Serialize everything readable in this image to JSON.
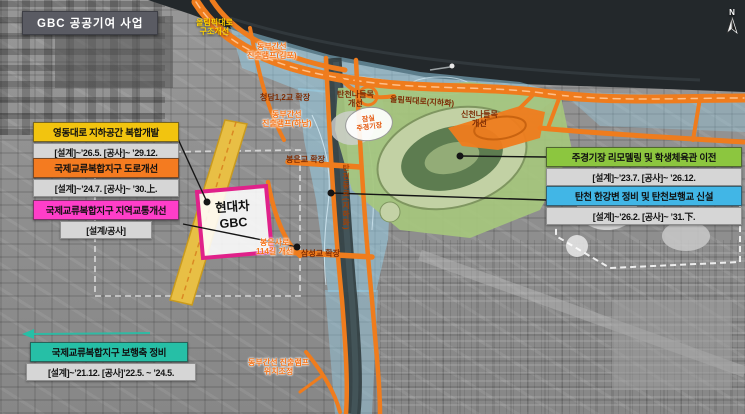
{
  "header": {
    "title": "GBC 공공기여 사업"
  },
  "compass": {
    "label": "N"
  },
  "colors": {
    "yellow": "#f2c40f",
    "orange": "#f47b20",
    "magenta": "#ff3ec9",
    "green": "#8cc63f",
    "blue": "#41b6e6",
    "teal": "#26bfa6",
    "schedule_bg": "#d6d6d6",
    "road_orange": "#ef7c1d",
    "han_river": "#23282b",
    "overlay_blue": "#96d2eb",
    "stadium_green": "#a6c77d",
    "yeongdong_band_yellow": "#e8bf45",
    "site_border_magenta": "#e0218a"
  },
  "callouts": [
    {
      "title": "영동대로 지하공간 복합개발",
      "schedule": "[설계]~’26.5. [공사]~ ’29.12.",
      "color": "#f2c40f"
    },
    {
      "title": "국제교류복합지구 도로개선",
      "schedule": "[설계]~’24.7. [공사]~ ’30.上.",
      "color": "#f47b20"
    },
    {
      "title": "국제교류복합지구 지역교통개선",
      "schedule": "[설계/공사]",
      "color": "#ff3ec9"
    },
    {
      "title": "주경기장 리모델링 및 학생체육관 이전",
      "schedule": "[설계]~’23.7. [공사]~ ’26.12.",
      "color": "#8cc63f"
    },
    {
      "title": "탄천 한강변 정비 및 탄천보행교 신설",
      "schedule": "[설계]~’26.2. [공사]~ ’31.下.",
      "color": "#41b6e6"
    },
    {
      "title": "국제교류복합지구 보행축 정비",
      "schedule": "[설계]~’21.12. [공사]’22.5. ~ ’24.5.",
      "color": "#26bfa6"
    }
  ],
  "map_labels": {
    "olympic_struct": {
      "l1": "올림픽대로",
      "l2": "구조개선"
    },
    "dongbu_gimpo": {
      "l1": "동부간선",
      "l2": "진출램프(김포)"
    },
    "cheongdam": {
      "l1": "청담1,2교 확장"
    },
    "tancheon_ic": {
      "l1": "탄천나들목",
      "l2": "개선"
    },
    "olympic_under": {
      "l1": "올림픽대로(지하화)"
    },
    "dongbu_hanam": {
      "l1": "동부간선",
      "l2": "진출램프(하남)"
    },
    "jamsil_stadium": {
      "l1": "잠실",
      "l2": "주경기장"
    },
    "sincheon_ic": {
      "l1": "신천나들목",
      "l2": "개선"
    },
    "bongeun_bridge": {
      "l1": "봉은교 확장"
    },
    "tancheondong_ro": {
      "l1": "탄천동로(지하화)"
    },
    "bongeunsa_ro": {
      "l1": "봉은사로",
      "l2": "114길 개선"
    },
    "samseong_bridge": {
      "l1": "삼성교 확장"
    },
    "dongbu_reloc": {
      "l1": "동부간선 진출램프",
      "l2": "위치조정"
    },
    "site": {
      "l1": "현대차",
      "l2": "GBC"
    }
  }
}
